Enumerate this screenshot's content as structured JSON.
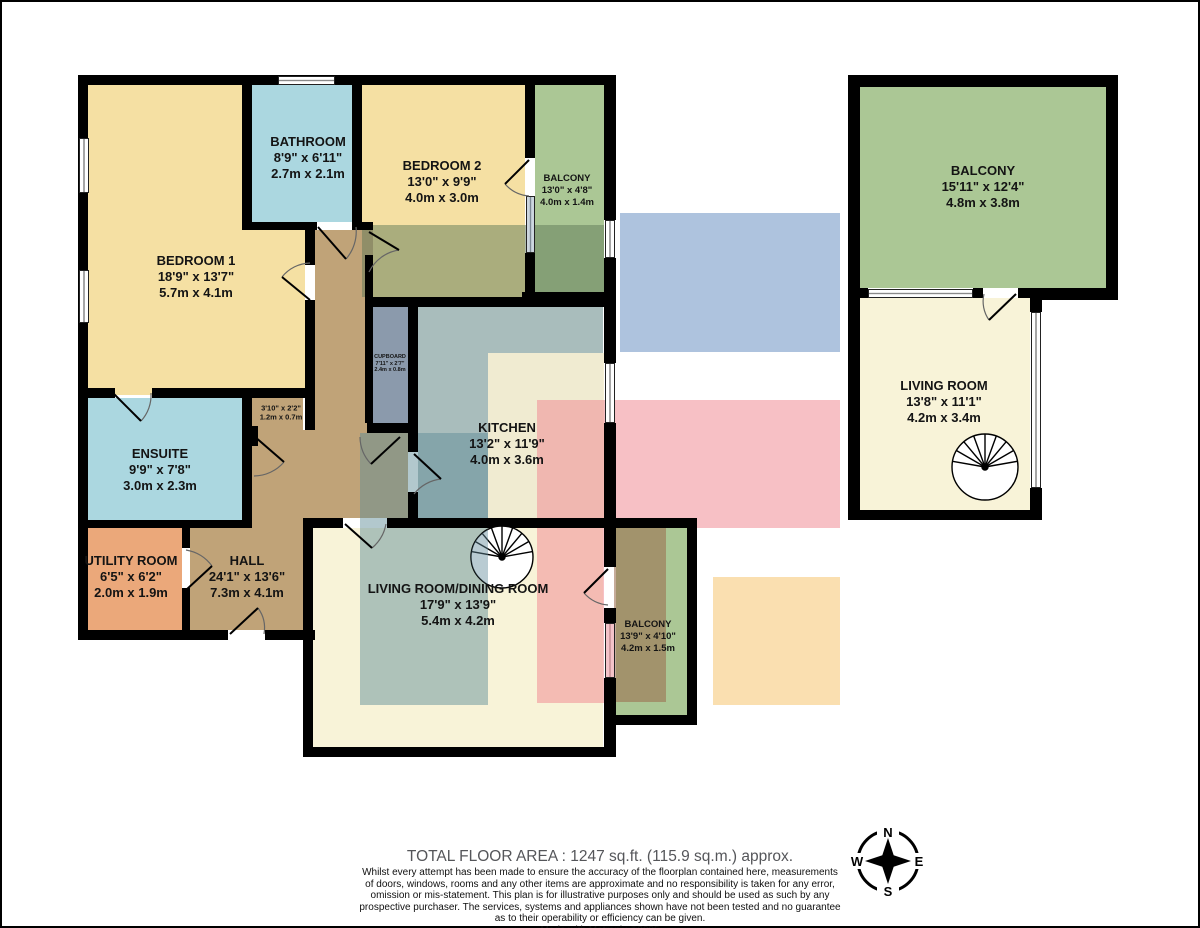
{
  "rooms": {
    "bedroom1": {
      "name": "BEDROOM 1",
      "imperial": "18'9\"  x 13'7\"",
      "metric": "5.7m  x 4.1m"
    },
    "bathroom": {
      "name": "BATHROOM",
      "imperial": "8'9\"  x 6'11\"",
      "metric": "2.7m  x 2.1m"
    },
    "bedroom2": {
      "name": "BEDROOM 2",
      "imperial": "13'0\"  x 9'9\"",
      "metric": "4.0m  x 3.0m"
    },
    "balcony_top": {
      "name": "BALCONY",
      "imperial": "13'0\"  x 4'8\"",
      "metric": "4.0m  x 1.4m"
    },
    "cupboard": {
      "name": "CUPBOARD",
      "imperial": "7'11\"  x 2'7\"",
      "metric": "2.4m  x 0.8m"
    },
    "closet": {
      "imperial": "3'10\"  x 2'2\"",
      "metric": "1.2m  x 0.7m"
    },
    "kitchen": {
      "name": "KITCHEN",
      "imperial": "13'2\"  x 11'9\"",
      "metric": "4.0m  x 3.6m"
    },
    "ensuite": {
      "name": "ENSUITE",
      "imperial": "9'9\"  x 7'8\"",
      "metric": "3.0m  x 2.3m"
    },
    "utility": {
      "name": "UTILITY ROOM",
      "imperial": "6'5\"  x 6'2\"",
      "metric": "2.0m  x 1.9m"
    },
    "hall": {
      "name": "HALL",
      "imperial": "24'1\"  x 13'6\"",
      "metric": "7.3m  x 4.1m"
    },
    "living_dining": {
      "name": "LIVING ROOM/DINING ROOM",
      "imperial": "17'9\"  x 13'9\"",
      "metric": "5.4m  x 4.2m"
    },
    "balcony_bottom": {
      "name": "BALCONY",
      "imperial": "13'9\"  x 4'10\"",
      "metric": "4.2m  x 1.5m"
    },
    "balcony_right": {
      "name": "BALCONY",
      "imperial": "15'11\"  x 12'4\"",
      "metric": "4.8m  x 3.8m"
    },
    "living_right": {
      "name": "LIVING ROOM",
      "imperial": "13'8\"  x 11'1\"",
      "metric": "4.2m  x 3.4m"
    }
  },
  "compass": {
    "north": "N",
    "east": "E",
    "south": "S",
    "west": "W"
  },
  "footer": {
    "total_area": "TOTAL FLOOR AREA : 1247 sq.ft. (115.9 sq.m.) approx.",
    "disclaimer_lines": [
      "Whilst every attempt has been made to ensure the accuracy of the floorplan contained here, measurements",
      "of doors, windows, rooms and any other items are approximate and no responsibility is taken for any error,",
      "omission or mis-statement. This plan is for illustrative purposes only and should be used as such by any",
      "prospective purchaser. The services, systems and appliances shown have not been tested and no guarantee",
      "as to their operability or efficiency can be given."
    ],
    "credit": "Made with Metropix ©2025"
  },
  "colors": {
    "bedroom": "#f5e0a3",
    "bath": "#abd7e0",
    "balcony": "#abc795",
    "hall": "#c0a378",
    "kitchen": "#a9bdbc",
    "living": "#f8f3d8",
    "utility": "#eba87a",
    "cupboard": "#8b9aac",
    "wall": "#000000",
    "overlay_blue": "#aec3de",
    "overlay_pink": "#f5b6bd",
    "overlay_orange": "#fadfb0",
    "overlay_sage": "#a9a87d",
    "overlay_teal": "#a9bfbc",
    "overlay_tan": "#a38f6f"
  }
}
